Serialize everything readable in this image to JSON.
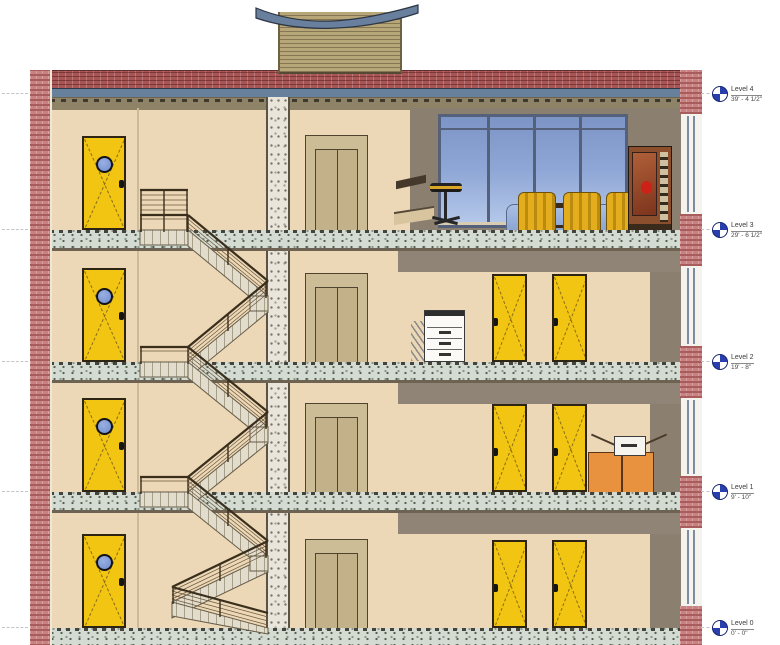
{
  "levels": [
    {
      "name": "Level 4",
      "elevation": "39' - 4 1/2\""
    },
    {
      "name": "Level 3",
      "elevation": "29' - 6 1/2\""
    },
    {
      "name": "Level 2",
      "elevation": "19' - 8\""
    },
    {
      "name": "Level 1",
      "elevation": "9' - 10\""
    },
    {
      "name": "Level 0",
      "elevation": "0' - 0\""
    }
  ],
  "icons": {
    "level_marker": "level-datum-target-icon"
  },
  "colors": {
    "brick_red": "#a85555",
    "brick_pink": "#c98181",
    "wall_tan": "#ecd8b6",
    "wall_taupe": "#8b8070",
    "door_yellow": "#f2c512",
    "porthole_blue": "#6f8cd0",
    "glass_blue": "#8ca4d4",
    "concrete": "#d4dbd2",
    "roof_blue_gray": "#697f9e",
    "marker_blue": "#2a3fae",
    "chair_gold": "#e3ad1e",
    "cart_orange": "#e8913f"
  }
}
